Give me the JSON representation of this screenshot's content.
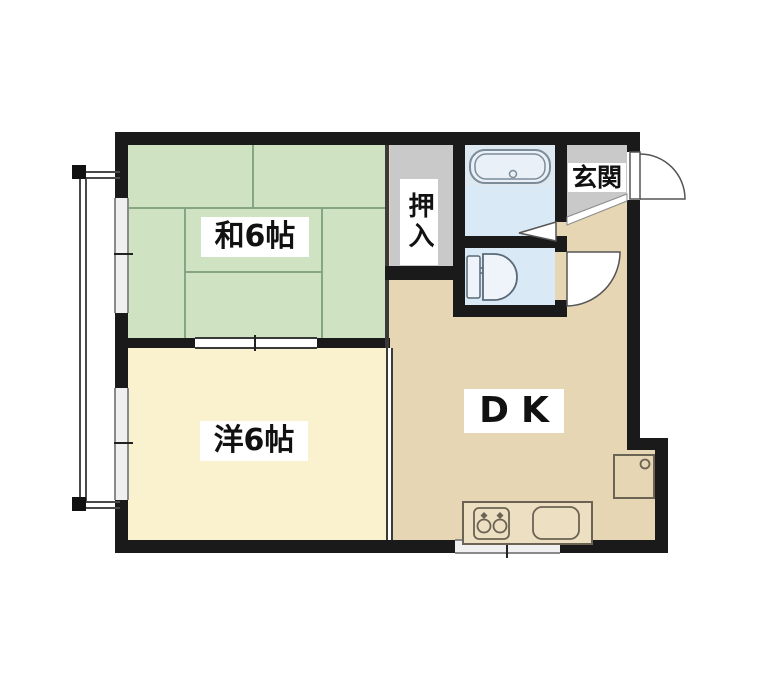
{
  "type": "apartment-floor-plan",
  "labels": {
    "washitsu": "和6帖",
    "youshitsu": "洋6帖",
    "dining_kitchen": "DK",
    "oshiire": "押入",
    "genkan": "玄関"
  },
  "rooms": [
    {
      "id": "washitsu",
      "label": "和6帖",
      "floor_color": "#cfe2c2"
    },
    {
      "id": "youshitsu",
      "label": "洋6帖",
      "floor_color": "#faf1cf"
    },
    {
      "id": "dining-kitchen",
      "label": "DK",
      "floor_color": "#e6d6b4"
    },
    {
      "id": "oshiire-closet",
      "label": "押入",
      "floor_color": "#c9c9c9"
    },
    {
      "id": "genkan-entrance",
      "label": "玄関",
      "floor_color": "#c9c9c9"
    },
    {
      "id": "bathroom",
      "label": "",
      "floor_color": "#d9e9f6"
    },
    {
      "id": "toilet-room",
      "label": "",
      "floor_color": "#d9e9f6"
    }
  ],
  "colors": {
    "wall": "#1a1a1a",
    "tatami_green": "#cfe2c2",
    "western_cream": "#faf1cf",
    "dk_tan": "#e6d6b4",
    "service_gray": "#c9c9c9",
    "water_blue": "#d9e9f6",
    "tub_surround": "#dee8f0",
    "label_bg": "#ffffff",
    "fixture_stroke": "#6b6353",
    "bath_stroke": "#7d8c99",
    "door_stroke": "#555555"
  },
  "fixtures": [
    "bathtub",
    "toilet",
    "kitchen-counter",
    "kitchen-stove-2-burner",
    "kitchen-sink",
    "washing-machine-pan",
    "entrance-swing-door",
    "toilet-swing-door",
    "bathroom-folding-door",
    "genkan-step-edge",
    "balcony-railing",
    "window-left-upper",
    "window-left-lower",
    "window-bottom",
    "sliding-door-tatami-room"
  ]
}
